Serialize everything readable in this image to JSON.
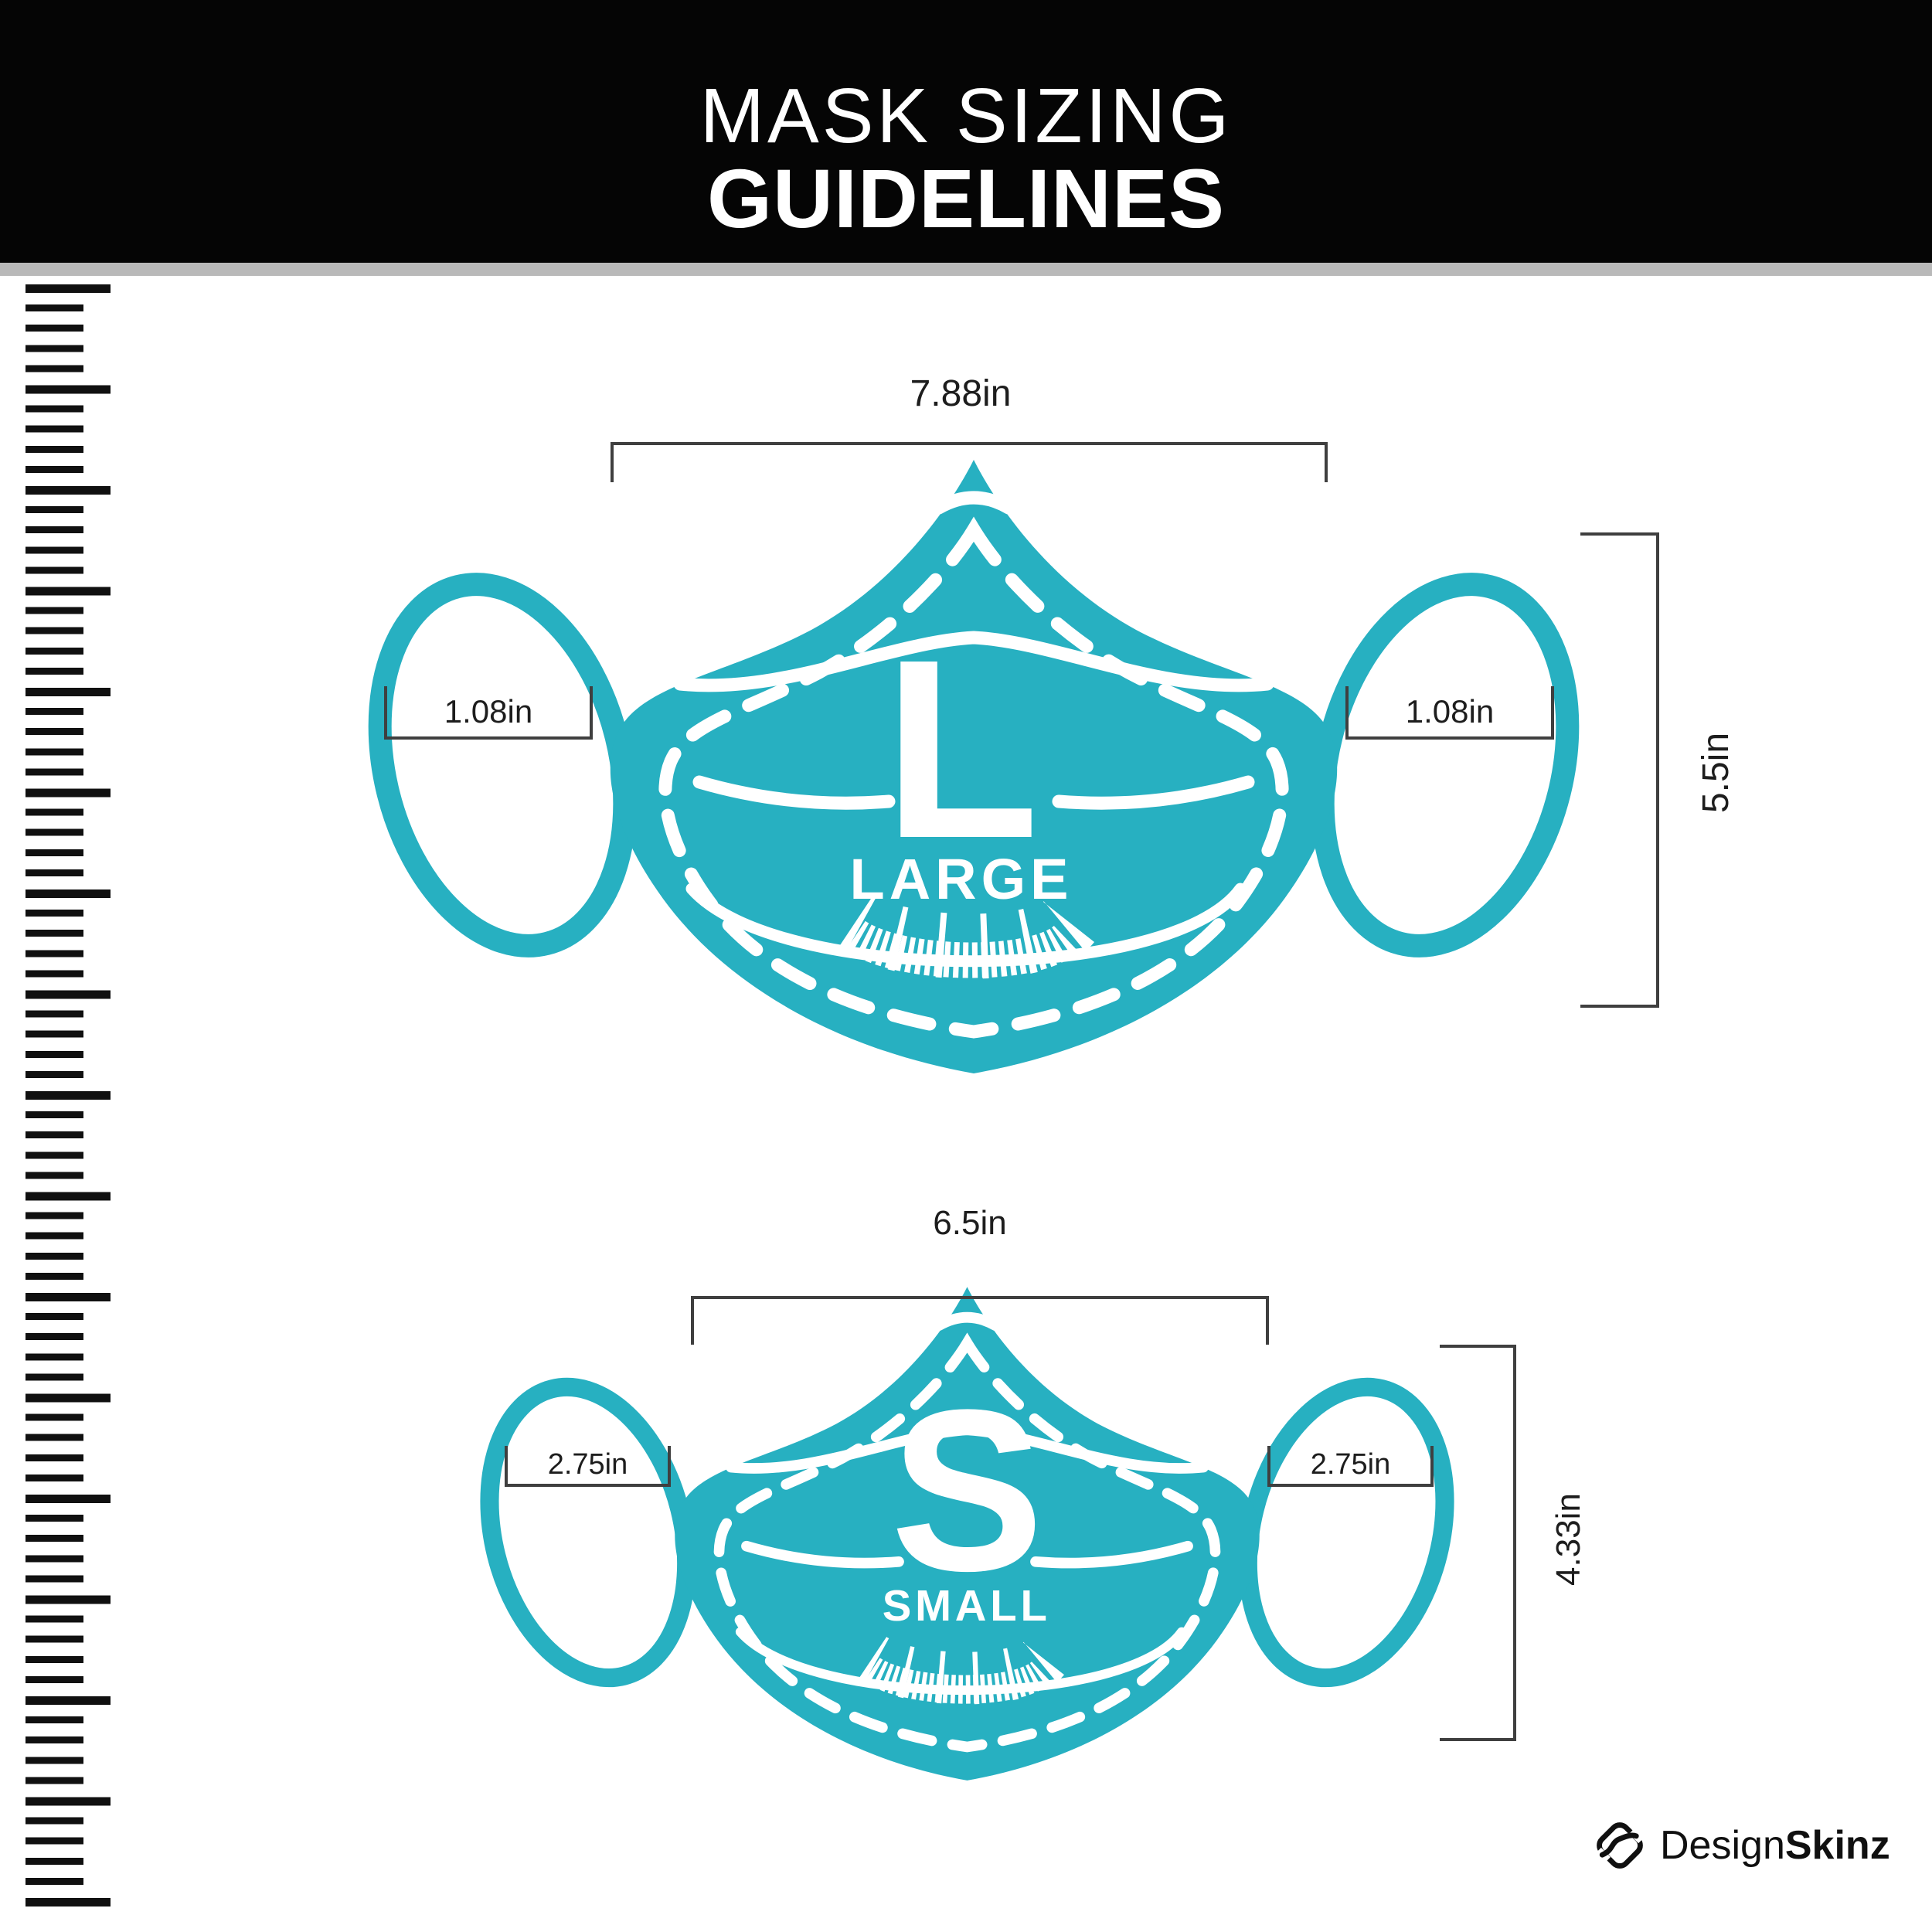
{
  "header": {
    "title_line1": "MASK SIZING",
    "title_line2": "GUIDELINES"
  },
  "large_mask": {
    "letter": "L",
    "size_name": "LARGE",
    "width_label": "7.88in",
    "height_label": "5.5in",
    "ear_left_label": "1.08in",
    "ear_right_label": "1.08in"
  },
  "small_mask": {
    "letter": "S",
    "size_name": "SMALL",
    "width_label": "6.5in",
    "height_label": "4.33in",
    "ear_left_label": "2.75in",
    "ear_right_label": "2.75in"
  },
  "footer": {
    "brand_regular": "Design",
    "brand_bold": "Skinz"
  },
  "colors": {
    "accent": "#27b0c1",
    "ink": "#1d1d1d",
    "bracket": "#3f3f3f",
    "header_bg": "#050505",
    "divider": "#b9b9b9"
  }
}
